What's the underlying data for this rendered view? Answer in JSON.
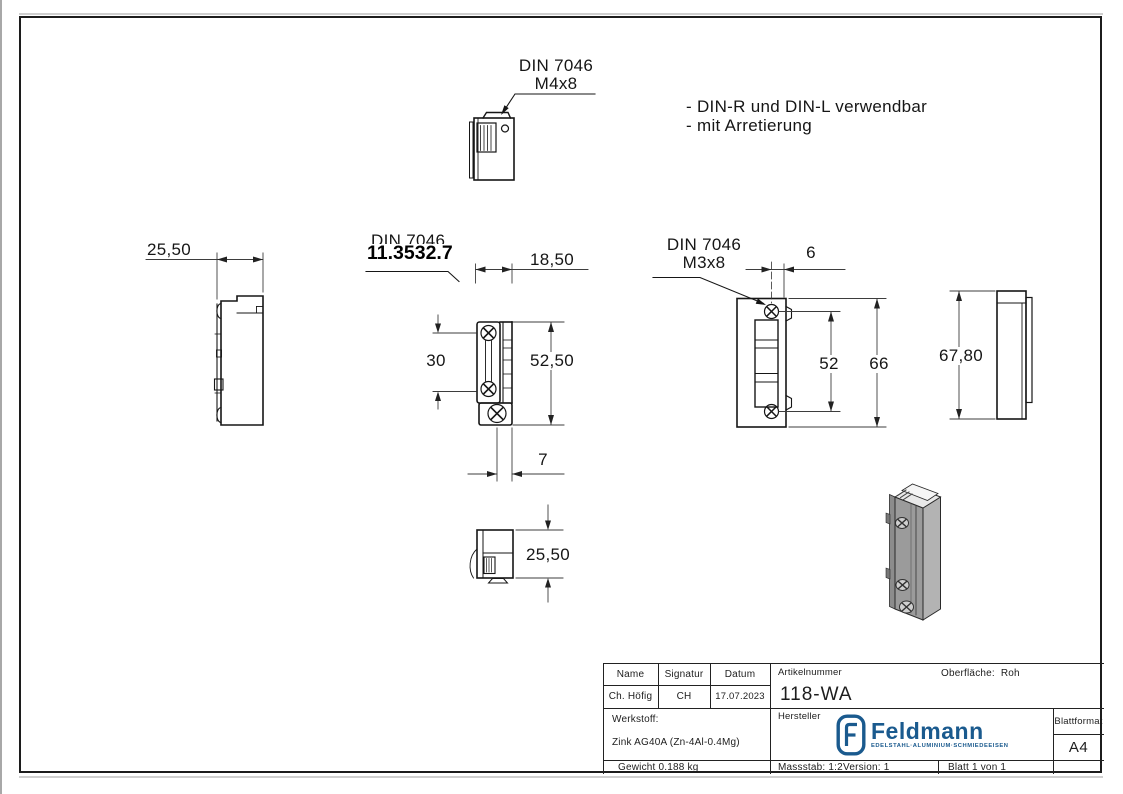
{
  "colors": {
    "line": "#161616",
    "dim_line": "#3d3d3d",
    "logo_blue": "#1a5a8e"
  },
  "notes": {
    "line1": "- DIN-R und DIN-L verwendbar",
    "line2": "- mit Arretierung"
  },
  "callouts": {
    "top_view_screw_line1": "DIN 7046",
    "top_view_screw_line2": "M4x8",
    "front_view_din": "DIN 7046",
    "front_view_part_number": "11.3532.7",
    "back_view_screw_line1": "DIN 7046",
    "back_view_screw_line2": "M3x8"
  },
  "dimensions": {
    "left_view_width": "25,50",
    "front_view_width": "18,50",
    "front_view_screw_spacing": "30",
    "front_view_height": "52,50",
    "front_view_offset": "7",
    "back_view_offset": "6",
    "back_view_screw_spacing": "52",
    "back_view_height": "66",
    "side_view_height": "67,80",
    "bottom_view_depth": "25,50"
  },
  "title_block": {
    "name_header": "Name",
    "signature_header": "Signatur",
    "date_header": "Datum",
    "name_value": "Ch. Höfig",
    "signature_value": "CH",
    "date_value": "17.07.2023",
    "article_number_label": "Artikelnummer",
    "article_number": "118-WA",
    "surface_label": "Oberfläche:",
    "surface_value": "Roh",
    "material_label": "Werkstoff:",
    "material_value": "Zink AG40A (Zn-4Al-0.4Mg)",
    "manufacturer_label": "Hersteller",
    "sheet_format_label": "Blattformat",
    "sheet_format_value": "A4",
    "weight": "Gewicht 0.188 kg",
    "scale": "Massstab: 1:2",
    "version": "Version: 1",
    "sheet": "Blatt 1 von 1",
    "logo": {
      "brand": "Feldmann",
      "tagline": "EDELSTAHL·ALUMINIUM·SCHMIEDEEISEN"
    }
  }
}
